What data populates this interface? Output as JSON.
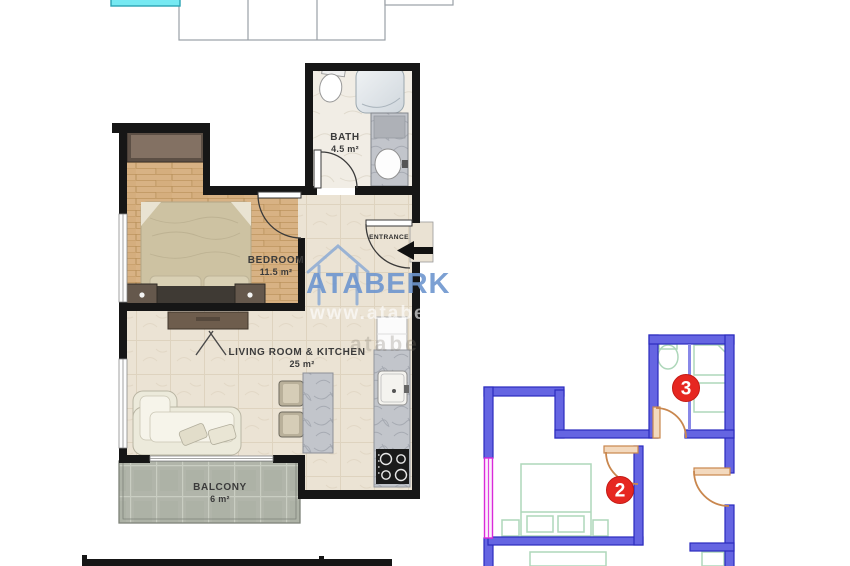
{
  "brand_watermark": {
    "text": "ATABERK",
    "url_text": "www.atabe",
    "url_text_2": "atabe",
    "color": "#6e96cf"
  },
  "main_plan": {
    "rooms": {
      "bath": {
        "name": "BATH",
        "area": "4.5 m²"
      },
      "bedroom": {
        "name": "BEDROOM",
        "area": "11.5 m²"
      },
      "living": {
        "name": "LIVING ROOM & KITCHEN",
        "area": "25 m²"
      },
      "balcony": {
        "name": "BALCONY",
        "area": "6 m²"
      }
    },
    "entrance_label": "ENTRANCE"
  },
  "mini_plan": {
    "badge_2": "2",
    "badge_3": "3",
    "colors": {
      "wall": "#6565e2",
      "wall_stroke": "#2b2bbf",
      "window": "#d92ad9",
      "door": "#c9874e",
      "furniture": "#aed7ba",
      "badge": "#e62721"
    }
  },
  "colors": {
    "wall_black": "#161616",
    "wood_floor": "#d8b284",
    "tile_beige": "#ece4d6",
    "balcony_gray": "#b1b5aa",
    "pool_cyan": "#76e9f2"
  }
}
